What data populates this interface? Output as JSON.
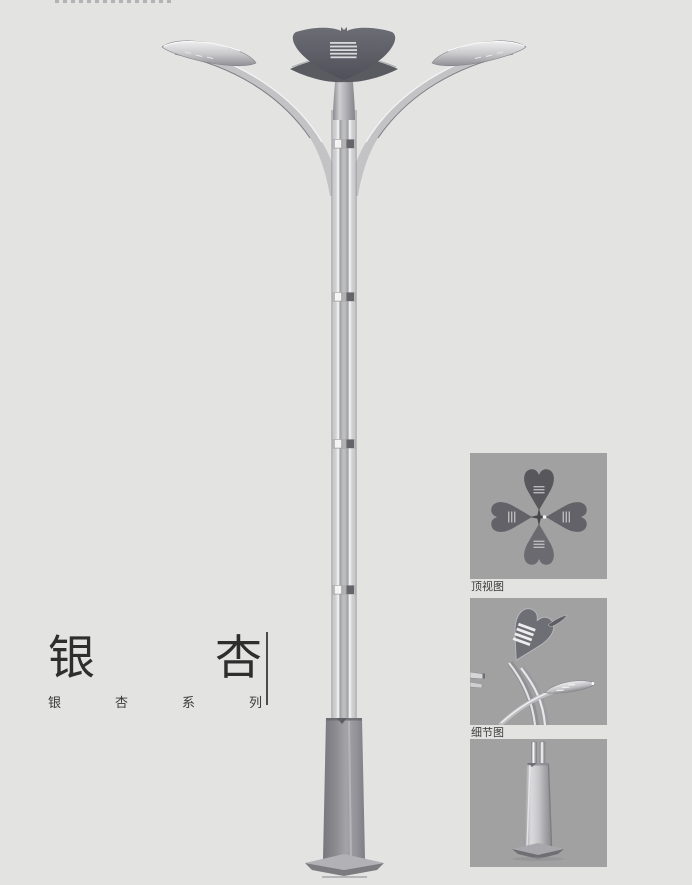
{
  "title_block": {
    "title_chars": [
      "银",
      "杏"
    ],
    "subtitle_chars": [
      "银",
      "杏",
      "系",
      "列"
    ]
  },
  "panels": {
    "top_view_label": "顶视图",
    "detail_view_label": "细节图"
  },
  "figures": {
    "main": "ginkgo-street-lamp-render",
    "panel1": "lamp-top-view-render",
    "panel2": "lamp-head-detail-render",
    "panel3": "lamp-base-render"
  },
  "colors": {
    "page_bg": "#e3e3e2",
    "panel_bg": "#a1a1a1",
    "text": "#2e2e2e",
    "metal_dark": "#5a5a61",
    "metal_light": "#c9c9cc"
  }
}
